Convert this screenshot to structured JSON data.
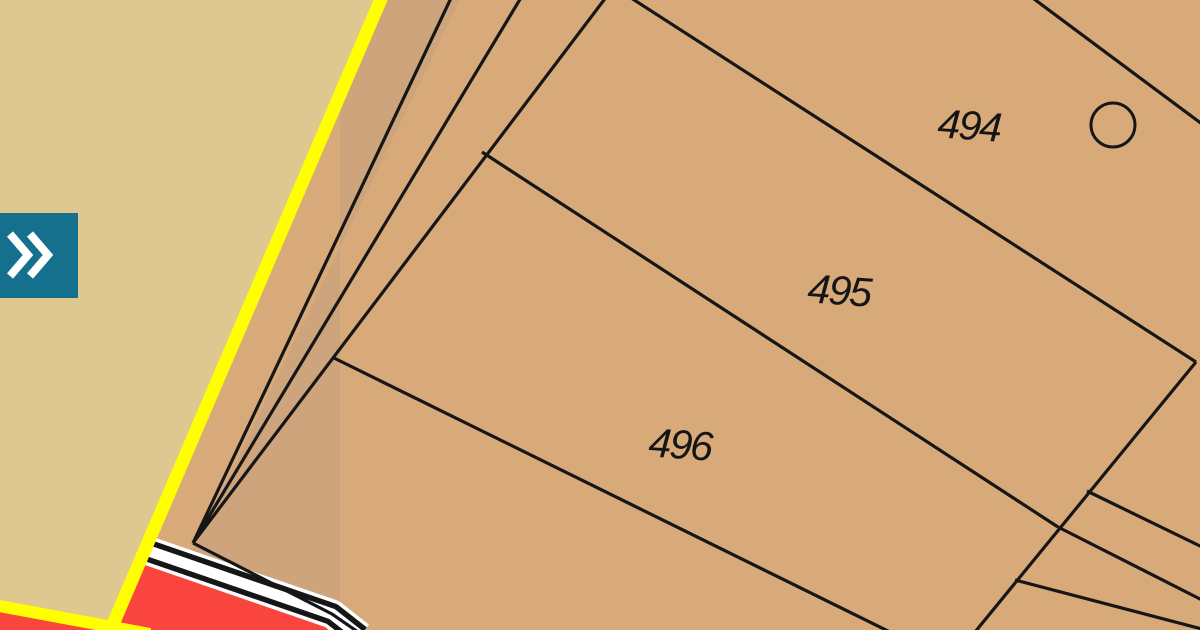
{
  "app": {
    "type": "cadastral-map-viewer",
    "description": "zoomed cadastral parcel map with sidebar expand control"
  },
  "map": {
    "parcels": [
      {
        "number": "494"
      },
      {
        "number": "495"
      },
      {
        "number": "496"
      }
    ],
    "features": {
      "survey_circle": {
        "present": true
      },
      "road_parcel": {
        "color_key": "road_fill"
      },
      "cadastral_boundary": {
        "color_key": "boundary_yellow"
      }
    },
    "colors": {
      "parcel_fill": "#D9AA79",
      "sliver_fill": "#CEA47C",
      "adjacent_fill": "#DEC88F",
      "road_fill": "#F9453E",
      "boundary_yellow": "#FFFF00",
      "line_black": "#161616",
      "casing_white": "#FFFFFF",
      "button_teal": "#15708E",
      "label_color": "#151515"
    }
  },
  "sidebar_toggle": {
    "icon": "double-chevron-right"
  }
}
